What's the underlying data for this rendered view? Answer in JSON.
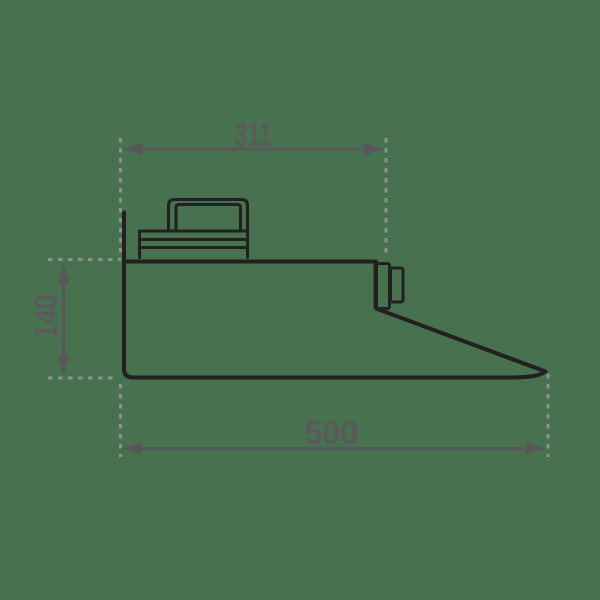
{
  "page": {
    "background_color": "#48724f"
  },
  "diagram": {
    "type": "technical-drawing",
    "subject": "cooker-hood-side-profile",
    "style": {
      "object_line_color": "#222020",
      "dimension_color": "#58585a",
      "extension_line_color": "#8f918f",
      "text_color": "#5a5a5c"
    },
    "dimensions": {
      "top_width": {
        "value": "311",
        "orientation": "horizontal",
        "position": "top"
      },
      "height": {
        "value": "140",
        "orientation": "vertical",
        "position": "left"
      },
      "total_width": {
        "value": "500",
        "orientation": "horizontal",
        "position": "bottom"
      }
    }
  }
}
